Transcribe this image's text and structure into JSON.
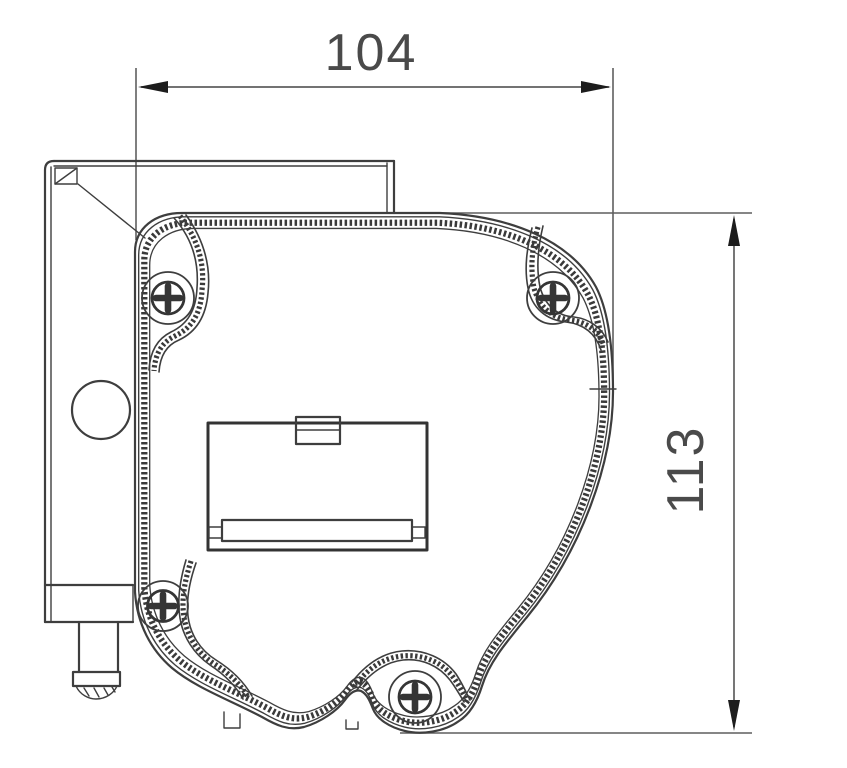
{
  "drawing": {
    "dimension_width": "104",
    "dimension_height": "113",
    "colors": {
      "line": "#3e3e3e",
      "dimension_line": "#5f5f5f",
      "arrow": "#1d1d1d",
      "text": "#4a4a4a",
      "background": "#ffffff"
    },
    "icons": [
      "phillips-screw-icon",
      "corner-marker-icon",
      "bracket-hole-icon"
    ]
  }
}
